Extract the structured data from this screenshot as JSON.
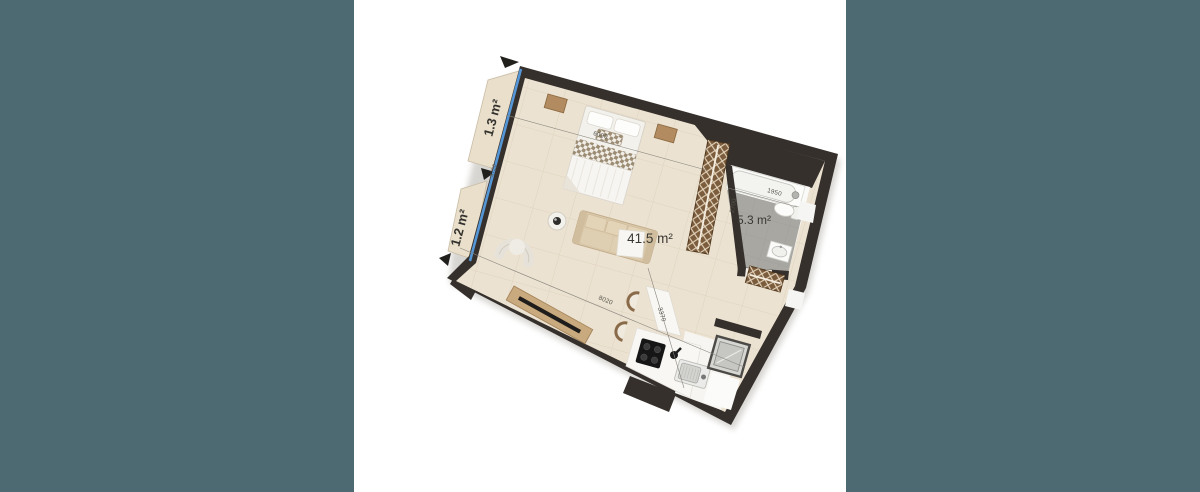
{
  "page": {
    "background_color": "#4d6a72",
    "stage_background": "#ffffff"
  },
  "floorplan": {
    "labels": {
      "living": "41.5 m²",
      "bathroom": "5.3 m²",
      "balcony_top": "1.3 m²",
      "balcony_bottom": "1.2 m²"
    },
    "dimensions": {
      "bed_wall": "6000",
      "window_wall": "4720",
      "diagonal": "8020",
      "cross": "3370",
      "bathroom_width": "1950",
      "bathroom_depth": "2700"
    },
    "colors": {
      "wall": "#35302c",
      "floor": "#ece2d1",
      "bathroom_floor": "#a8a7a2",
      "balcony_floor": "#e9dfca",
      "window_line": "#5596d6",
      "wardrobe": "#7b5c3d",
      "accent_wood": "#c9a97e"
    },
    "furniture": [
      "bed",
      "nightstand-left",
      "nightstand-right",
      "wardrobe",
      "wardrobe-hall",
      "sofa",
      "armchair",
      "side-table",
      "tv-cabinet",
      "dining-table",
      "chair",
      "chair",
      "cooktop",
      "kitchen-sink",
      "washing-machine",
      "bathtub",
      "toilet",
      "bathroom-sink"
    ]
  }
}
